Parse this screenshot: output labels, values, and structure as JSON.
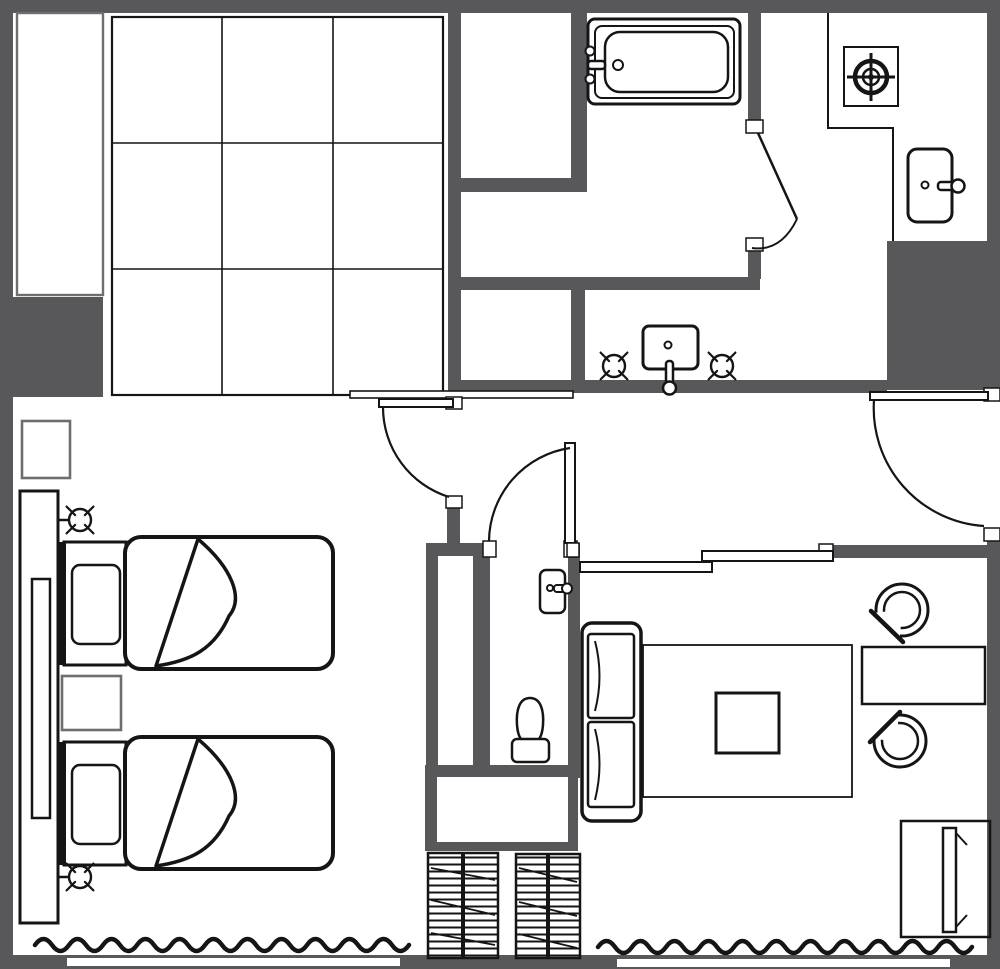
{
  "meta": {
    "title": "Hotel guest room floor plan",
    "diagram_type": "architectural-floor-plan",
    "visible_text": []
  },
  "colors": {
    "wall": "#58585a",
    "line": "#151515",
    "gray": "#6e6e6e",
    "bg": "#ffffff"
  },
  "plan": {
    "rooms": [
      {
        "name": "bedroom",
        "contents": [
          "twin-bed",
          "twin-bed",
          "nightstand",
          "nightstand",
          "headboard-panel",
          "wall-lamp-symbol",
          "wall-lamp-symbol",
          "curtain-wave"
        ]
      },
      {
        "name": "closet-grid-area",
        "contents": [
          "3x3-grid"
        ]
      },
      {
        "name": "storage-nook",
        "contents": []
      },
      {
        "name": "bathroom",
        "contents": [
          "bathtub",
          "swing-door"
        ]
      },
      {
        "name": "vanity-room",
        "contents": [
          "wash-basin",
          "lamp-symbol",
          "lamp-symbol"
        ]
      },
      {
        "name": "toilet-room",
        "contents": [
          "toilet",
          "small-sink",
          "swing-door"
        ]
      },
      {
        "name": "kitchenette",
        "contents": [
          "stove-burner",
          "kitchen-sink",
          "counter"
        ]
      },
      {
        "name": "corridor",
        "contents": [
          "entry-door",
          "sliding-partition"
        ]
      },
      {
        "name": "living-room",
        "contents": [
          "sofa",
          "rug",
          "coffee-table",
          "tub-chair",
          "tub-chair",
          "desk",
          "tv-cabinet",
          "curtain-wave"
        ]
      },
      {
        "name": "balcony-strip",
        "contents": [
          "louvered-unit",
          "louvered-unit",
          "window-band",
          "window-band"
        ]
      }
    ],
    "counts": {
      "beds": 2,
      "chairs": 2,
      "doors": 4,
      "sliding-panels": 2,
      "lamp-symbols": 4
    }
  }
}
